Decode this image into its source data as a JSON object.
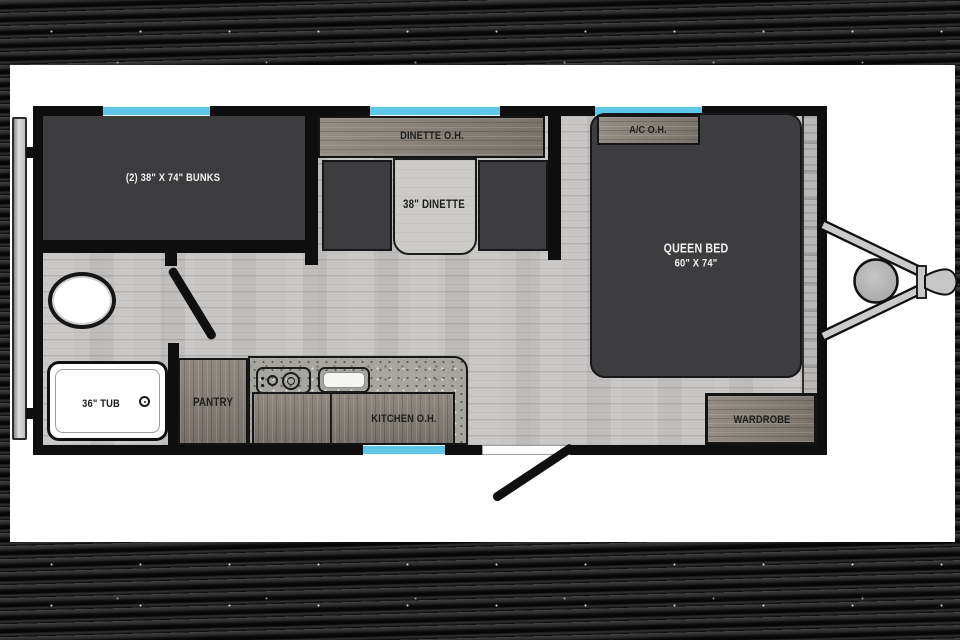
{
  "title": "travel-trailer-floorplan",
  "colors": {
    "window_accent": "#5ec7e7",
    "wall": "#0e0e0e",
    "dark_furniture": "#3d3d3f",
    "floor": "#c7c6c4",
    "wood_cabinet": "#867f78",
    "canvas": "#ffffff",
    "background": "#0c0c0c"
  },
  "rooms": {
    "bunks": {
      "label": "(2) 38\" X 74\" BUNKS"
    },
    "dinette": {
      "overhead": "DINETTE O.H.",
      "table": "38\" DINETTE"
    },
    "bedroom": {
      "overhead": "A/C O.H.",
      "bed_line1": "QUEEN BED",
      "bed_line2": "60\" X 74\"",
      "wardrobe": "WARDROBE"
    },
    "bathroom": {
      "tub": "36\" TUB"
    },
    "kitchen": {
      "pantry": "PANTRY",
      "overhead": "KITCHEN O.H."
    }
  }
}
